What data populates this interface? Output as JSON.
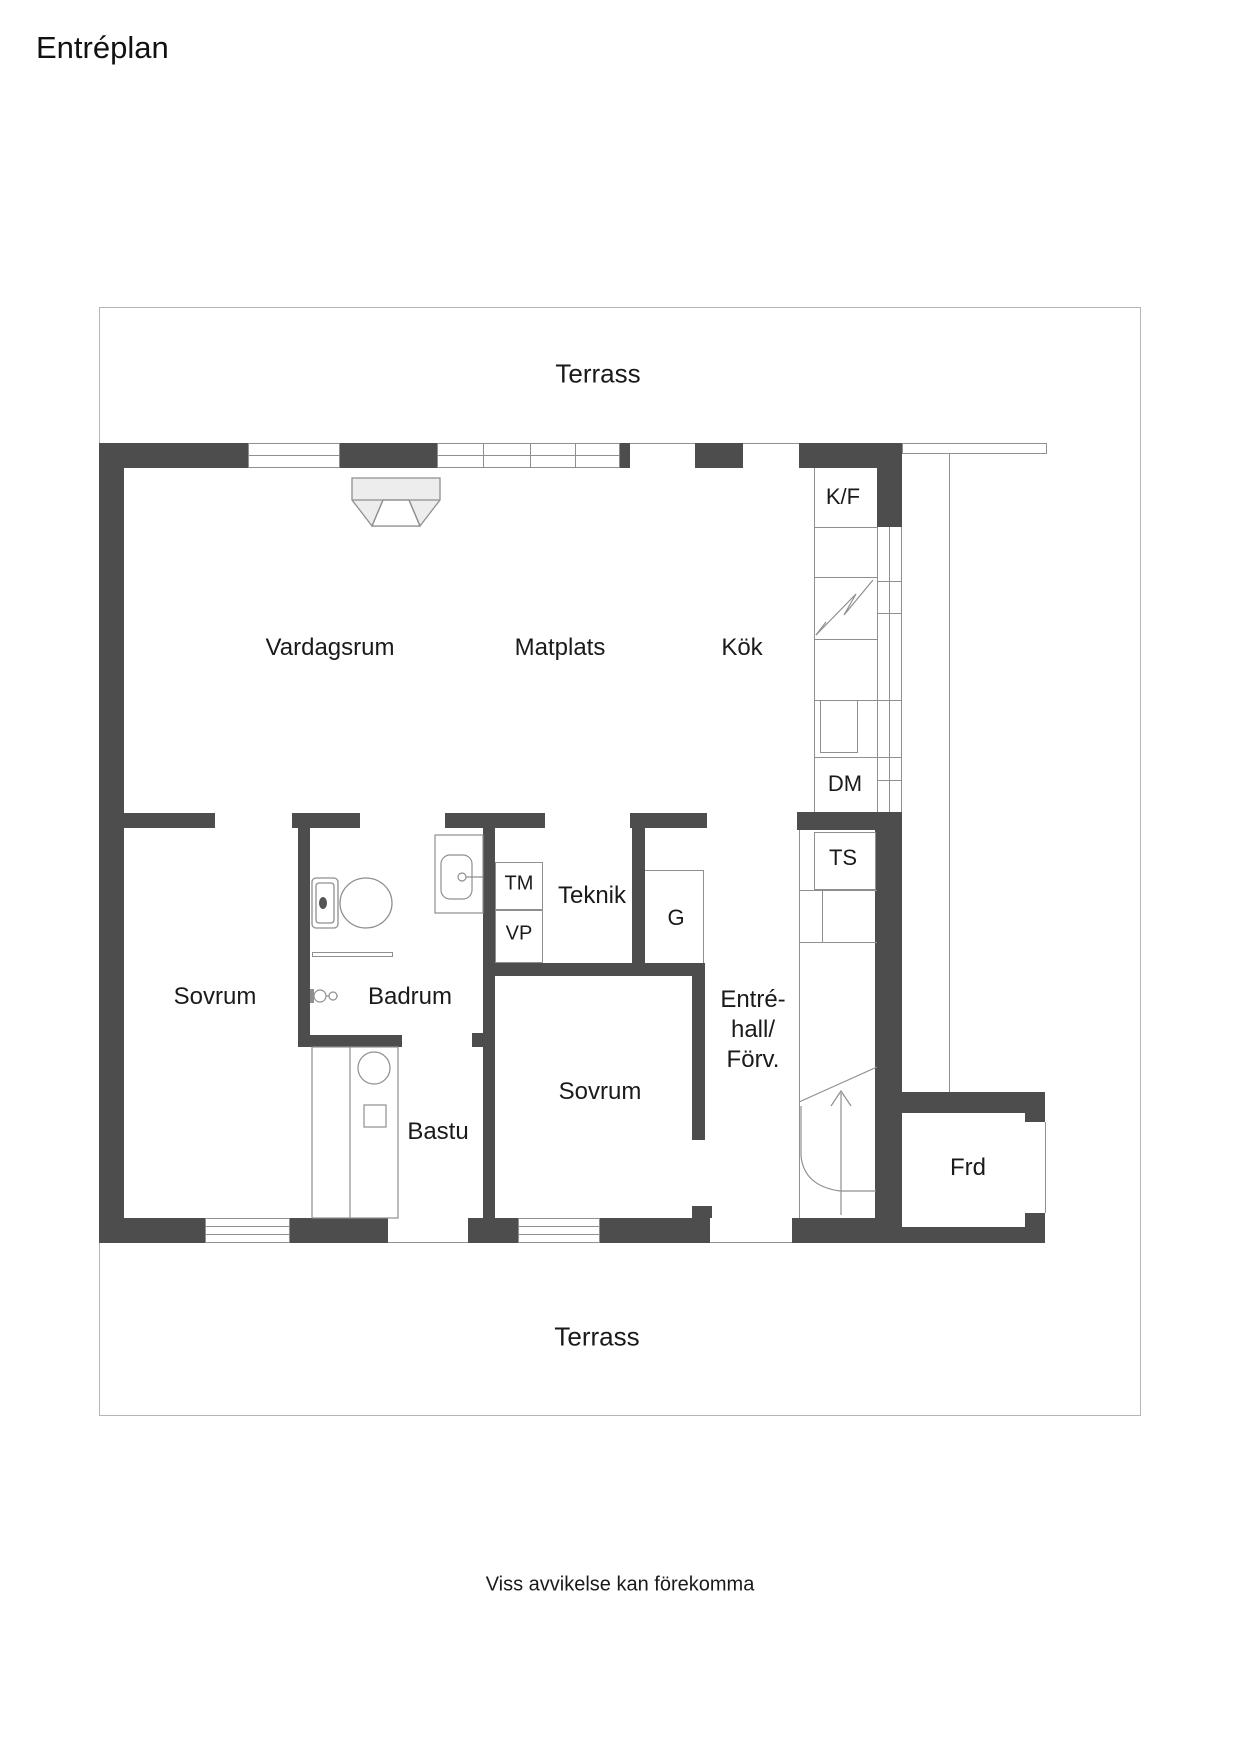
{
  "page": {
    "title": "Entréplan",
    "disclaimer": "Viss avvikelse kan förekomma"
  },
  "terrace": {
    "label_top": "Terrass",
    "label_bottom": "Terrass"
  },
  "rooms": [
    {
      "id": "vardagsrum",
      "label": "Vardagsrum"
    },
    {
      "id": "matplats",
      "label": "Matplats"
    },
    {
      "id": "kok",
      "label": "Kök"
    },
    {
      "id": "sovrum-1",
      "label": "Sovrum"
    },
    {
      "id": "badrum",
      "label": "Badrum"
    },
    {
      "id": "bastu",
      "label": "Bastu"
    },
    {
      "id": "sovrum-2",
      "label": "Sovrum"
    },
    {
      "id": "teknik",
      "label": "Teknik"
    },
    {
      "id": "frd",
      "label": "Frd"
    }
  ],
  "hall": {
    "line1": "Entré-",
    "line2": "hall/",
    "line3": "Förv."
  },
  "fixtures": [
    {
      "id": "kf",
      "label": "K/F"
    },
    {
      "id": "dm",
      "label": "DM"
    },
    {
      "id": "ts",
      "label": "TS"
    },
    {
      "id": "tm",
      "label": "TM"
    },
    {
      "id": "vp",
      "label": "VP"
    },
    {
      "id": "g",
      "label": "G"
    }
  ],
  "icons": [
    "fireplace-icon",
    "stove-lightning-icon",
    "toilet-icon",
    "sink-icon",
    "shower-mixer-icon",
    "towel-rail-icon",
    "sauna-heater-icon",
    "stair-arrow-icon",
    "door-swing-icon",
    "window"
  ],
  "colors": {
    "wall": "#4d4d4d",
    "thin_line": "#8f8f8f",
    "terrace_border": "#b5b5b5",
    "text": "#1a1a1a",
    "background": "#ffffff"
  }
}
